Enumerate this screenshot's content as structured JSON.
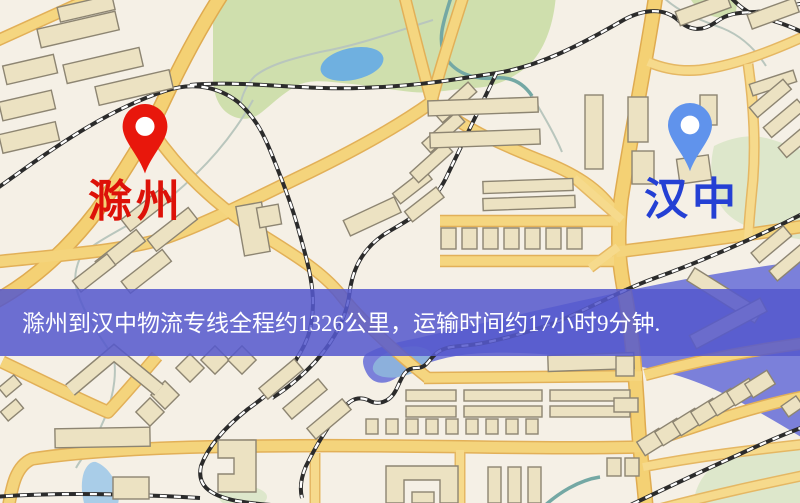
{
  "map": {
    "title": "route-map",
    "city_a": {
      "name": "滁州",
      "pin_color": "#e8170c",
      "label_color": "#dd1108"
    },
    "city_b": {
      "name": "汉中",
      "pin_color": "#6093ec",
      "label_color": "#2440d4"
    },
    "banner": {
      "text": "滁州到汉中物流专线全程约1326公里，运输时间约17小时9分钟.",
      "bg": "#5558cd",
      "text_color": "#ffffff"
    },
    "route_info": {
      "origin": "滁州",
      "destination": "汉中",
      "distance_text": "约1326公里",
      "duration_text": "约17小时9分钟"
    },
    "palette": {
      "background": "#f5f0e6",
      "road": "#f4d174",
      "road_casing": "#dfab50",
      "rail": "#2b2b2b",
      "building": "#ece2c2",
      "building_outline": "#8d8572",
      "park": "#cfdfad",
      "park_pale": "#dde7cb",
      "water_lake": "#6fb0e0",
      "water_light": "#a9cde8",
      "water_indigo": "#7b80da"
    },
    "icons": {
      "pin_a": "map-pin-icon",
      "pin_b": "map-pin-icon"
    }
  }
}
